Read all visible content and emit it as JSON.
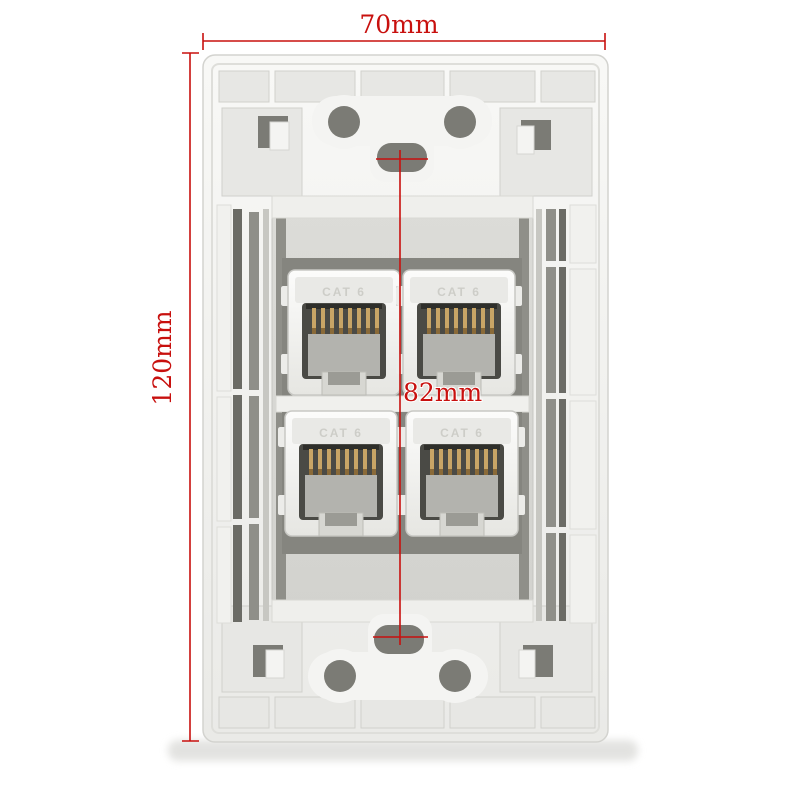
{
  "annotations": {
    "accent_color": "#c8100e",
    "width": {
      "label": "70mm"
    },
    "height": {
      "label": "120mm"
    },
    "mount_spacing": {
      "label": "82mm"
    }
  },
  "plate": {
    "body_color": "#f2f2ef",
    "rib_cell_color": "#e7e7e4",
    "recess_color": "#d9d9d5",
    "cutout_color": "#85857f",
    "slot_dark_color": "#6b6b65",
    "slot_mid_color": "#8f8f89",
    "hole_color": "#7b7b75",
    "jack_label_color": "#c9c9c3",
    "pin_color": "#c8a566",
    "jacks": [
      {
        "label": "CAT 6"
      },
      {
        "label": "CAT 6"
      },
      {
        "label": "CAT 6"
      },
      {
        "label": "CAT 6"
      }
    ]
  },
  "shadow_color": "#dededb"
}
